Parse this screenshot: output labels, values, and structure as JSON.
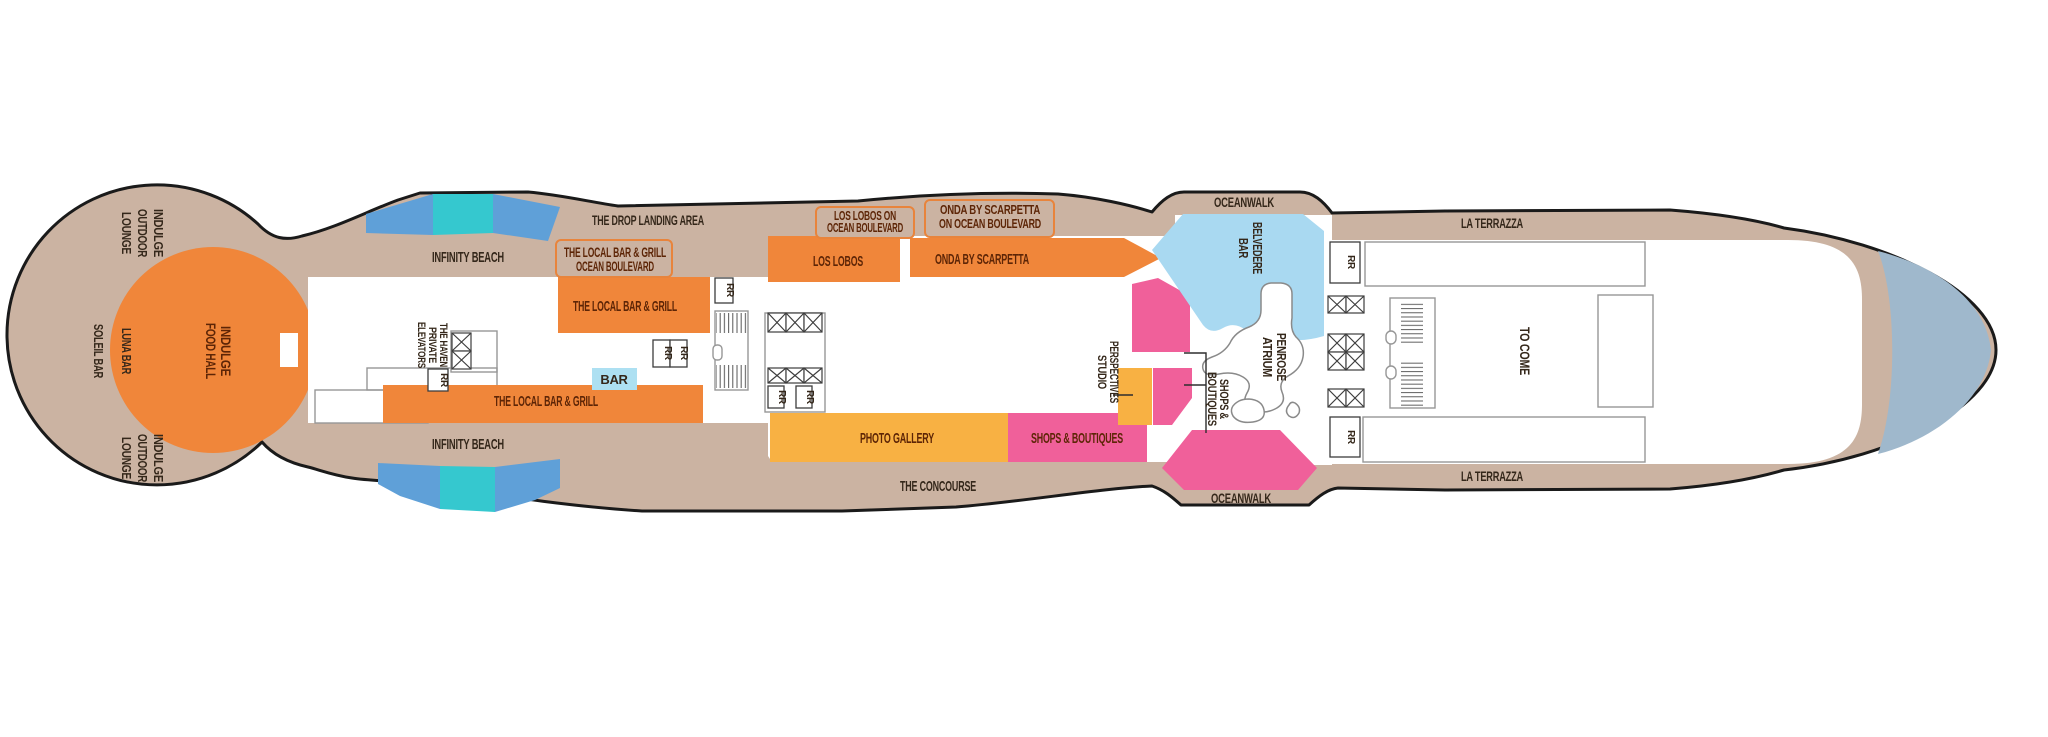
{
  "palette": {
    "hull_band": "#CBB3A2",
    "outline": "#1A1A1A",
    "room_orange": "#F0863A",
    "room_amber": "#F8B143",
    "room_pink": "#F0609A",
    "bar_light_blue": "#ADE0F2",
    "belvedere_blue": "#A9D9F1",
    "pool_blue": "#5FA0D8",
    "pool_teal": "#35C8CF",
    "bow_blue_gray": "#9FB8CC",
    "label_ink": "#34271A",
    "room_label_ink": "#5D2506"
  },
  "ship": {
    "stern": {
      "outdoor_lounge_top": [
        "INDULGE",
        "OUTDOOR",
        "LOUNGE"
      ],
      "soleil_bar": "SOLEIL BAR",
      "luna_bar": "LUNA BAR",
      "food_hall": [
        "INDULGE",
        "FOOD HALL"
      ],
      "outdoor_lounge_bottom": [
        "INDULGE",
        "OUTDOOR",
        "LOUNGE"
      ]
    },
    "midship_left": {
      "infinity_beach_top": "INFINITY BEACH",
      "infinity_beach_bottom": "INFINITY BEACH",
      "drop_landing": "THE DROP LANDING AREA",
      "local_ocean_blvd": [
        "THE LOCAL BAR & GRILL",
        "OCEAN BOULEVARD"
      ],
      "local_top": "THE LOCAL BAR & GRILL",
      "local_bottom": "THE LOCAL BAR & GRILL",
      "bar": "BAR",
      "haven_elevators": [
        "THE HAVEN",
        "PRIVATE",
        "ELEVATORS"
      ]
    },
    "midship_center": {
      "los_lobos_blvd": [
        "LOS LOBOS ON",
        "OCEAN BOULEVARD"
      ],
      "los_lobos": "LOS LOBOS",
      "onda_blvd": [
        "ONDA BY SCARPETTA",
        "ON OCEAN BOULEVARD"
      ],
      "onda": "ONDA BY SCARPETTA",
      "photo_gallery": "PHOTO GALLERY",
      "shops_boutiques_room": "SHOPS & BOUTIQUES",
      "concourse": "THE CONCOURSE"
    },
    "atrium": {
      "oceanwalk_top": "OCEANWALK",
      "oceanwalk_bottom": "OCEANWALK",
      "belvedere_bar": [
        "BELVEDERE",
        "BAR"
      ],
      "penrose_atrium": [
        "PENROSE",
        "ATRIUM"
      ],
      "perspectives_studio": [
        "PERSPECTIVES",
        "STUDIO"
      ],
      "shops_boutiques_callout": [
        "SHOPS &",
        "BOUTIQUES"
      ]
    },
    "forward": {
      "la_terrazza_top": "LA TERRAZZA",
      "la_terrazza_bottom": "LA TERRAZZA",
      "to_come": "TO COME"
    },
    "common": {
      "restroom": "RR"
    }
  }
}
